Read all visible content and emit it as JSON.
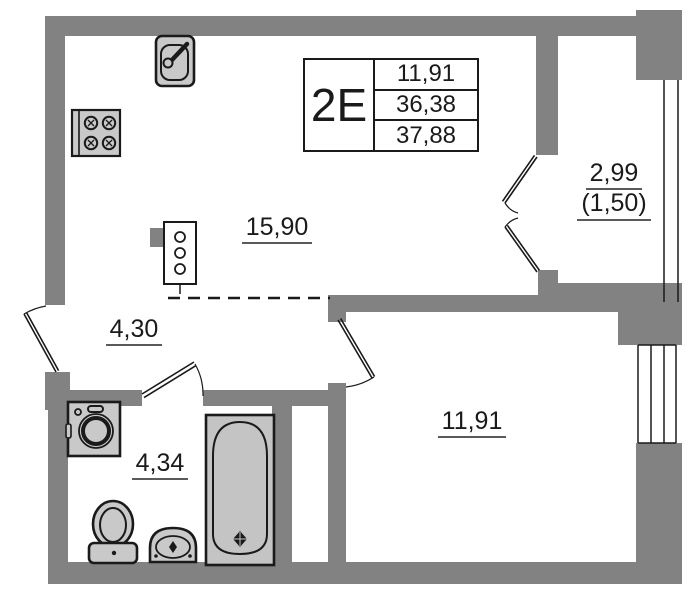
{
  "plan": {
    "title_block": {
      "unit_type": "2Е",
      "values": [
        "11,91",
        "36,38",
        "37,88"
      ]
    },
    "rooms": [
      {
        "name": "kitchen-living-room",
        "area": "15,90"
      },
      {
        "name": "hallway",
        "area": "4,30"
      },
      {
        "name": "bathroom",
        "area": "4,34"
      },
      {
        "name": "bedroom",
        "area": "11,91"
      },
      {
        "name": "balcony",
        "area": "2,99",
        "reduced_area": "(1,50)"
      }
    ],
    "fixtures": [
      "kitchen-sink",
      "stove-4-burner",
      "ventilation-riser",
      "washing-machine",
      "toilet",
      "wash-basin",
      "bathtub"
    ],
    "colors": {
      "wall": "#828282",
      "fixture_fill": "#c9c9c9",
      "outline": "#1a1a1a",
      "background": "#ffffff"
    }
  }
}
